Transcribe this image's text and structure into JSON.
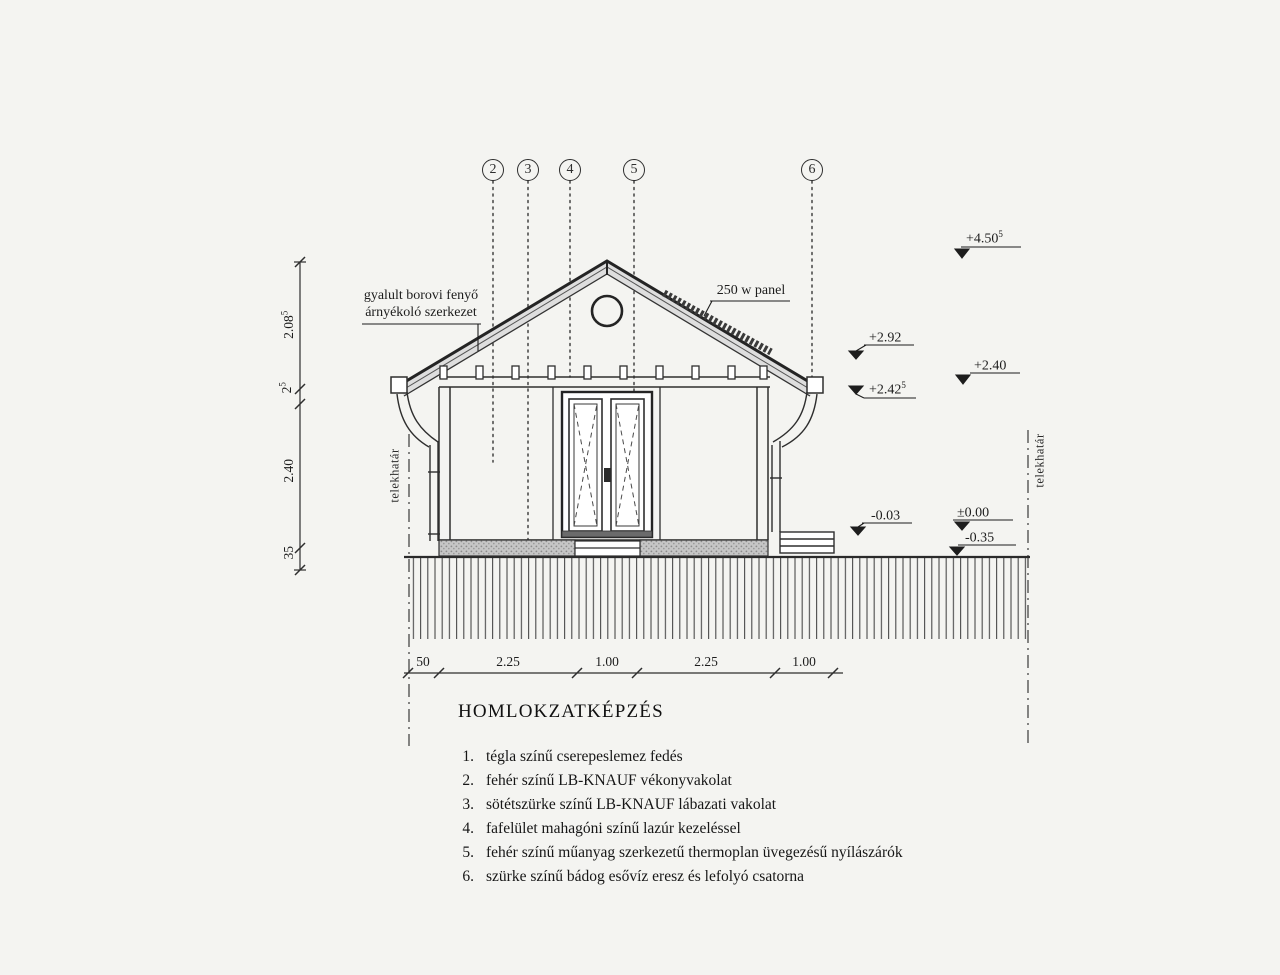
{
  "title": "HOMLOKZATKÉPZÉS",
  "markers": [
    {
      "label": "2"
    },
    {
      "label": "3"
    },
    {
      "label": "4"
    },
    {
      "label": "5"
    },
    {
      "label": "6"
    }
  ],
  "annotations": {
    "shading_line1": "gyalult borovi fenyő",
    "shading_line2": "árnyékoló szerkezet",
    "panel": "250 w panel",
    "boundary_left": "telekhatár",
    "boundary_right": "telekhatár"
  },
  "elevations": {
    "peak": {
      "value": "+4.50",
      "sup": "5"
    },
    "ridge_beam": {
      "value": "+2.92",
      "sup": ""
    },
    "eave": {
      "value": "+2.40",
      "sup": ""
    },
    "wall_top": {
      "value": "+2.42",
      "sup": "5"
    },
    "terrain": {
      "value": "-0.03",
      "sup": ""
    },
    "floor_zero": {
      "value": "±0.00",
      "sup": ""
    },
    "foundation": {
      "value": "-0.35",
      "sup": ""
    }
  },
  "dimensions": {
    "left": [
      {
        "value": "2.08",
        "sup": "5"
      },
      {
        "value": "2",
        "sup": "5"
      },
      {
        "value": "2.40",
        "sup": ""
      },
      {
        "value": "35",
        "sup": ""
      }
    ],
    "bottom": [
      "50",
      "2.25",
      "1.00",
      "2.25",
      "1.00"
    ]
  },
  "legend": [
    {
      "num": "1.",
      "text": "tégla színű cserepeslemez fedés"
    },
    {
      "num": "2.",
      "text": "fehér színű LB-KNAUF vékonyvakolat"
    },
    {
      "num": "3.",
      "text": "sötétszürke színű LB-KNAUF lábazati vakolat"
    },
    {
      "num": "4.",
      "text": "fafelület mahagóni színű lazúr kezeléssel"
    },
    {
      "num": "5.",
      "text": "fehér színű műanyag szerkezetű thermoplan üvegezésű nyílászárók"
    },
    {
      "num": "6.",
      "text": "szürke színű bádog esővíz eresz és lefolyó csatorna"
    }
  ],
  "colors": {
    "line": "#2e2e2e",
    "roof_fill": "#dedede",
    "plinth_fill": "#c9c9c9"
  }
}
